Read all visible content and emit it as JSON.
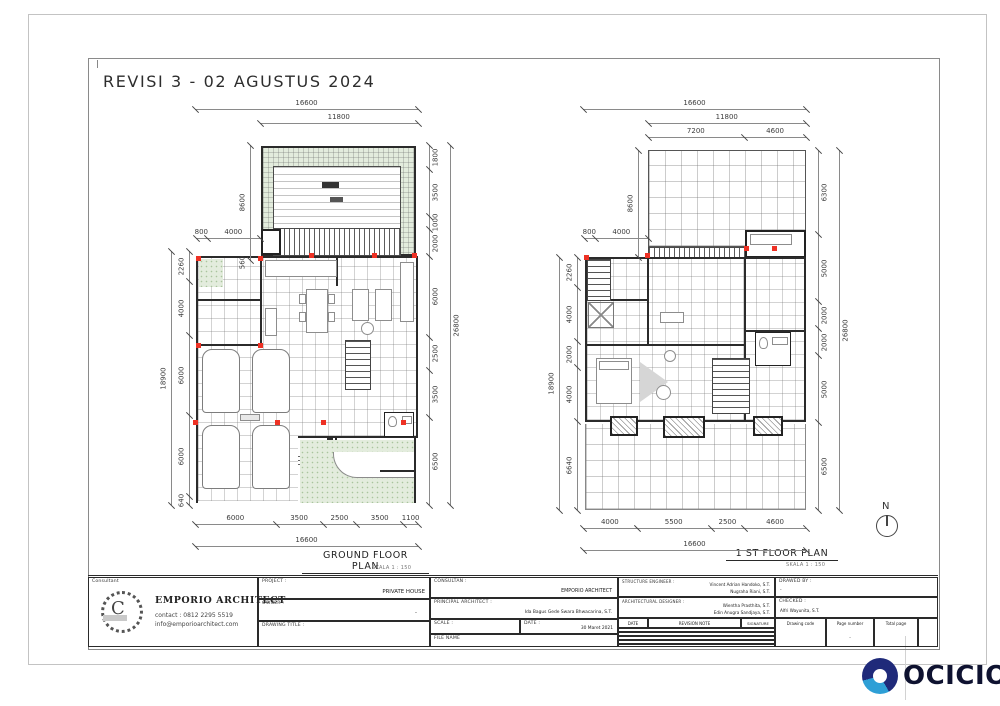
{
  "header": {
    "revision_title": "REVISI 3 - 02 AGUSTUS 2024"
  },
  "plans": {
    "ground": {
      "label": "GROUND FLOOR PLAN",
      "scale_note": "SKALA 1 : 150",
      "dims": {
        "top_total": [
          "16600"
        ],
        "top_inner": [
          "11800"
        ],
        "topleft": [
          "800",
          "4000"
        ],
        "offset": [
          "560"
        ],
        "setback": [
          "8600"
        ],
        "left": [
          "2260",
          "4000",
          "6000",
          "6000",
          "640"
        ],
        "left_total": [
          "18900"
        ],
        "right": [
          "1800",
          "3500",
          "1000",
          "2000",
          "6000",
          "2500",
          "3500",
          "6500"
        ],
        "right_total": [
          "26800"
        ],
        "bottom": [
          "6000",
          "3500",
          "2500",
          "3500",
          "1100"
        ],
        "bottom_total": [
          "16600"
        ]
      }
    },
    "first": {
      "label": "1 ST FLOOR PLAN",
      "scale_note": "SKALA 1 : 150",
      "dims": {
        "top_total": [
          "16600"
        ],
        "top_inner": [
          "11800"
        ],
        "top_split": [
          "7200",
          "4600"
        ],
        "topleft": [
          "800",
          "4000"
        ],
        "setback": [
          "8600"
        ],
        "left": [
          "2260",
          "4000",
          "2000",
          "4000",
          "6640"
        ],
        "left_total": [
          "18900"
        ],
        "right": [
          "6300",
          "5000",
          "2000",
          "2000",
          "5000",
          "6500"
        ],
        "right_total": [
          "26800"
        ],
        "bottom": [
          "4000",
          "5500",
          "2500",
          "4600"
        ],
        "bottom_total": [
          "16600"
        ]
      }
    }
  },
  "north": {
    "label": "N"
  },
  "titleblock": {
    "consultant_label": "Consultant",
    "firm": "EMPORIO ARCHITECT",
    "contact": "contact : 0812 2295 5519",
    "email": "info@emporioarchitect.com",
    "project_label": "PROJECT :",
    "project_value": "PRIVATE HOUSE",
    "owner_label": "OWNER :",
    "owner_value": "-",
    "drawing_title_label": "DRAWING TITLE :",
    "consultan_label": "CONSULTAN :",
    "consultan_value": "EMPORIO ARCHITECT",
    "principal_label": "PRINCIPAL ARCHITECT :",
    "principal_value": "Ida Bagus Gede Swara Bhwacarina, S.T.",
    "scale_label": "SCALE :",
    "date_label": "DATE :",
    "date_value": "30 Maret 2021",
    "file_label": "FILE NAME",
    "structure_label": "STRUCTURE ENGINEER :",
    "structure_value1": "Vincent Adrian Handoko, S.T.",
    "structure_value2": "Nugraha Riani, S.T.",
    "archdes_label": "ARCHITECTURAL DESIGNER :",
    "archdes_value1": "Wientha Prasthita, S.T.",
    "archdes_value2": "Edin Anugra Sandjaya, S.T.",
    "drawed_label": "DRAWED BY :",
    "drawed_value": "-",
    "checked_label": "CHECKED :",
    "checked_value": "Alfri Wayunita, S.T.",
    "rev_date_header": "DATE",
    "rev_note_header": "REVISION NOTE",
    "signature_header": "SIGNATURE",
    "code_header": "Drawing code",
    "page_header": "Page number",
    "total_header": "Total page",
    "page_value": "-"
  },
  "brand": {
    "name": "OCICIO"
  },
  "colors": {
    "garden": "#e3ecdd",
    "column_marker": "#ee3124",
    "wall": "#2b2b2b",
    "brand_ring": "#1f2a7a",
    "brand_swirl": "#2e9fd6",
    "brand_text": "#0e1230"
  }
}
